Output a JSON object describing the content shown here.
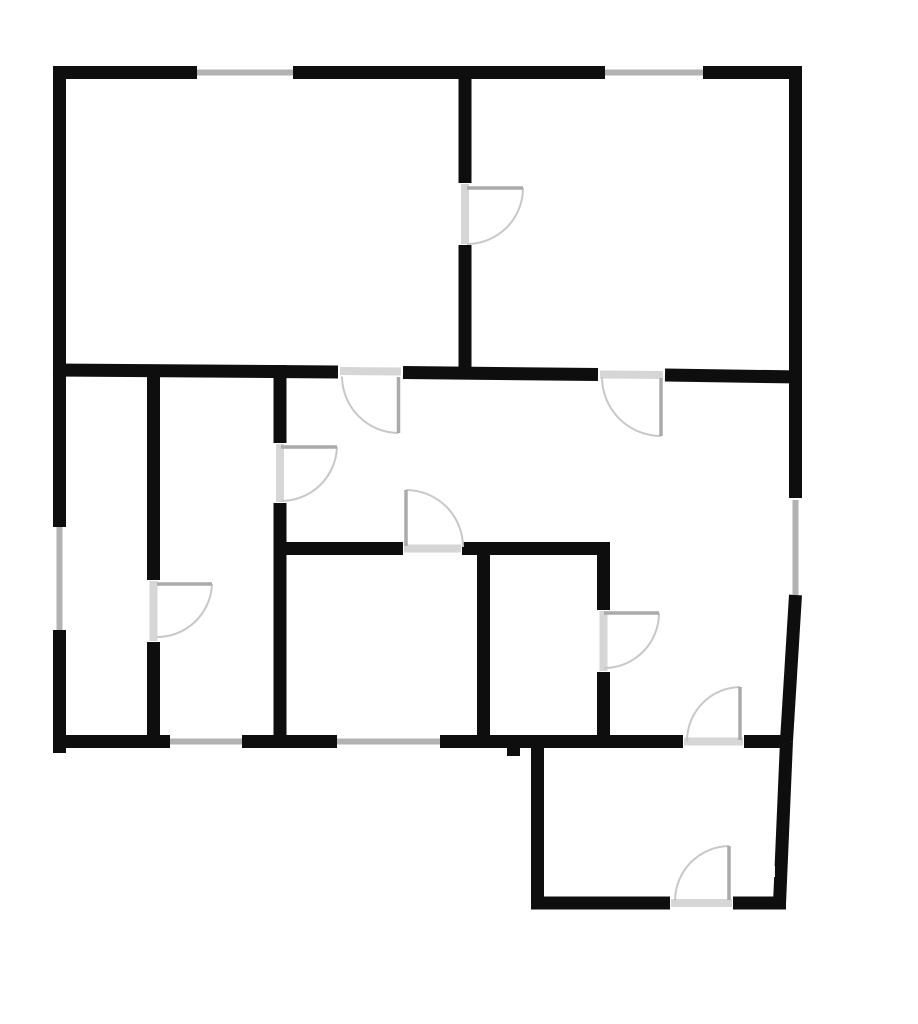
{
  "title": "apartment-floor-plan",
  "canvas": {
    "width": 918,
    "height": 1024,
    "background": "#ffffff"
  },
  "style": {
    "wall_color": "#0e0e0e",
    "wall_thickness": 13,
    "window_color": "#b2b2b2",
    "window_thickness": 6,
    "threshold_color": "#d6d6d6",
    "threshold_thickness": 8,
    "door_leaf_color": "#aaaaaa",
    "door_leaf_thickness": 3.5,
    "door_arc_color": "#c8c8c8",
    "door_arc_thickness": 2
  },
  "walls": [
    {
      "name": "top-wall-left",
      "x1": 53,
      "y1": 72.5,
      "x2": 197,
      "y2": 72.5
    },
    {
      "name": "top-wall-mid",
      "x1": 293,
      "y1": 72.5,
      "x2": 605,
      "y2": 72.5
    },
    {
      "name": "top-wall-right",
      "x1": 703,
      "y1": 72.5,
      "x2": 802,
      "y2": 72.5
    },
    {
      "name": "left-wall-upper",
      "x1": 59.5,
      "y1": 66,
      "x2": 59.5,
      "y2": 527
    },
    {
      "name": "left-wall-lower",
      "x1": 59.5,
      "y1": 630,
      "x2": 59.5,
      "y2": 753
    },
    {
      "name": "right-wall-upper",
      "x1": 795.5,
      "y1": 66,
      "x2": 795.5,
      "y2": 498
    },
    {
      "name": "right-wall-mid-slant",
      "x1": 795.5,
      "y1": 595,
      "x2": 786.5,
      "y2": 741
    },
    {
      "name": "right-wall-lower-slant",
      "x1": 786.5,
      "y1": 741,
      "x2": 779.5,
      "y2": 904
    },
    {
      "name": "mid-wall-left",
      "x1": 53,
      "y1": 370,
      "x2": 338,
      "y2": 372
    },
    {
      "name": "mid-wall-center",
      "x1": 403,
      "y1": 372.5,
      "x2": 598,
      "y2": 374.5
    },
    {
      "name": "mid-wall-right",
      "x1": 665,
      "y1": 375,
      "x2": 800,
      "y2": 377
    },
    {
      "name": "top-rooms-divider-upper",
      "x1": 465,
      "y1": 66,
      "x2": 465,
      "y2": 183
    },
    {
      "name": "top-rooms-divider-lower",
      "x1": 465,
      "y1": 245,
      "x2": 465,
      "y2": 379
    },
    {
      "name": "bottom-wall-1",
      "x1": 53,
      "y1": 741.5,
      "x2": 170,
      "y2": 741.5
    },
    {
      "name": "bottom-wall-2",
      "x1": 242,
      "y1": 741.5,
      "x2": 337,
      "y2": 741.5
    },
    {
      "name": "bottom-wall-3",
      "x1": 440,
      "y1": 741.5,
      "x2": 683,
      "y2": 741.5
    },
    {
      "name": "bottom-wall-4",
      "x1": 744,
      "y1": 741.5,
      "x2": 790,
      "y2": 741.5
    },
    {
      "name": "bottom-wall-stub",
      "x1": 513.5,
      "y1": 741.5,
      "x2": 513.5,
      "y2": 756
    },
    {
      "name": "left-room-divider-upper",
      "x1": 153.5,
      "y1": 365,
      "x2": 153.5,
      "y2": 580
    },
    {
      "name": "left-room-divider-lower",
      "x1": 153.5,
      "y1": 642,
      "x2": 153.5,
      "y2": 747
    },
    {
      "name": "second-divider-upper",
      "x1": 280,
      "y1": 365,
      "x2": 280,
      "y2": 443
    },
    {
      "name": "second-divider-lower",
      "x1": 280,
      "y1": 503,
      "x2": 280,
      "y2": 747
    },
    {
      "name": "lower-horizontal-left",
      "x1": 273.5,
      "y1": 548.5,
      "x2": 403,
      "y2": 548.5
    },
    {
      "name": "lower-horizontal-right",
      "x1": 462,
      "y1": 548.5,
      "x2": 610,
      "y2": 548.5
    },
    {
      "name": "bottom-rooms-divider",
      "x1": 483.5,
      "y1": 542,
      "x2": 483.5,
      "y2": 747
    },
    {
      "name": "small-room-divider-upper",
      "x1": 603.5,
      "y1": 542,
      "x2": 603.5,
      "y2": 610
    },
    {
      "name": "small-room-divider-lower",
      "x1": 603.5,
      "y1": 672,
      "x2": 603.5,
      "y2": 747
    },
    {
      "name": "vestibule-left-wall",
      "x1": 537.5,
      "y1": 741,
      "x2": 537.5,
      "y2": 909
    },
    {
      "name": "vestibule-bottom-left",
      "x1": 531,
      "y1": 903,
      "x2": 670,
      "y2": 903
    },
    {
      "name": "vestibule-bottom-right",
      "x1": 733,
      "y1": 903,
      "x2": 786,
      "y2": 903
    }
  ],
  "windows": [
    {
      "name": "window-top-left",
      "x1": 197,
      "y1": 72.5,
      "x2": 293,
      "y2": 72.5
    },
    {
      "name": "window-top-right",
      "x1": 605,
      "y1": 72.5,
      "x2": 703,
      "y2": 72.5
    },
    {
      "name": "window-left-wall",
      "x1": 59.5,
      "y1": 527,
      "x2": 59.5,
      "y2": 630
    },
    {
      "name": "window-right-wall",
      "x1": 795.5,
      "y1": 500,
      "x2": 795.5,
      "y2": 595
    },
    {
      "name": "window-bottom-left",
      "x1": 170,
      "y1": 741.5,
      "x2": 242,
      "y2": 741.5
    },
    {
      "name": "window-bottom-mid",
      "x1": 337,
      "y1": 741.5,
      "x2": 440,
      "y2": 741.5
    }
  ],
  "thresholds": [
    {
      "name": "threshold-top-left-room",
      "x1": 340,
      "y1": 371,
      "x2": 401,
      "y2": 371.5
    },
    {
      "name": "threshold-top-right-room",
      "x1": 600,
      "y1": 374.5,
      "x2": 663,
      "y2": 375
    },
    {
      "name": "threshold-between-top-rooms",
      "x1": 465,
      "y1": 184,
      "x2": 465,
      "y2": 244
    },
    {
      "name": "threshold-hall-middle-room",
      "x1": 280,
      "y1": 444,
      "x2": 280,
      "y2": 502
    },
    {
      "name": "threshold-left-room",
      "x1": 153.5,
      "y1": 581,
      "x2": 153.5,
      "y2": 641
    },
    {
      "name": "threshold-bottom-left-room",
      "x1": 404,
      "y1": 548.5,
      "x2": 461,
      "y2": 548.5
    },
    {
      "name": "threshold-small-room",
      "x1": 603.5,
      "y1": 611,
      "x2": 603.5,
      "y2": 671
    },
    {
      "name": "threshold-vestibule-top",
      "x1": 684,
      "y1": 741.5,
      "x2": 743,
      "y2": 741.5
    },
    {
      "name": "threshold-entry-door",
      "x1": 671,
      "y1": 903,
      "x2": 732,
      "y2": 903
    }
  ],
  "doors": [
    {
      "name": "door-top-left-room",
      "leaf": {
        "x1": 398.5,
        "y1": 377,
        "x2": 398.5,
        "y2": 433
      },
      "arc": "M 342 376.5 A 57 57 0 0 0 398.5 433"
    },
    {
      "name": "door-top-right-room",
      "leaf": {
        "x1": 661,
        "y1": 378,
        "x2": 661,
        "y2": 436
      },
      "arc": "M 602 377 A 59 59 0 0 0 661 436"
    },
    {
      "name": "door-between-top-rooms",
      "leaf": {
        "x1": 467,
        "y1": 188,
        "x2": 523,
        "y2": 188
      },
      "arc": "M 523 188 A 56 56 0 0 1 467 244"
    },
    {
      "name": "door-hall-middle-room",
      "leaf": {
        "x1": 281,
        "y1": 447,
        "x2": 337,
        "y2": 447
      },
      "arc": "M 337 447 A 56 56 0 0 1 281 501"
    },
    {
      "name": "door-left-room",
      "leaf": {
        "x1": 157,
        "y1": 584,
        "x2": 212,
        "y2": 584
      },
      "arc": "M 212 584 A 55 55 0 0 1 157 637"
    },
    {
      "name": "door-bottom-left-room",
      "leaf": {
        "x1": 406,
        "y1": 490,
        "x2": 406,
        "y2": 546
      },
      "arc": "M 406 490 A 57 57 0 0 1 463 547"
    },
    {
      "name": "door-small-room",
      "leaf": {
        "x1": 604,
        "y1": 613,
        "x2": 659,
        "y2": 613
      },
      "arc": "M 659 613 A 55 55 0 0 1 604 668"
    },
    {
      "name": "door-vestibule-top",
      "leaf": {
        "x1": 740,
        "y1": 687,
        "x2": 740,
        "y2": 740
      },
      "arc": "M 740 687 A 54 54 0 0 0 687 741"
    },
    {
      "name": "door-entry",
      "leaf": {
        "x1": 729,
        "y1": 846,
        "x2": 729,
        "y2": 900
      },
      "arc": "M 729 846 A 55 55 0 0 0 675 901"
    }
  ],
  "notches": [
    {
      "name": "right-wall-notch",
      "x": 766,
      "y": 866,
      "w": 9,
      "h": 11
    }
  ]
}
